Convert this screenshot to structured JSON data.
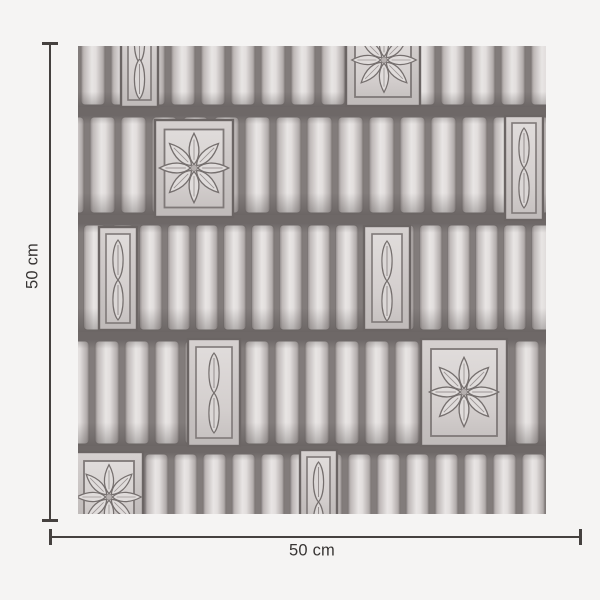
{
  "dimensions": {
    "height_label": "50 cm",
    "width_label": "50 cm"
  },
  "swatch": {
    "kind": "wallpaper-pattern-sample",
    "motifs": [
      "vertical-ribbed-slats",
      "eight-petal-flower-medallion",
      "leaf-chain-panel"
    ]
  },
  "colors": {
    "page_background": "#f5f4f3",
    "dimension_line": "#45413f",
    "label_text": "#383534",
    "pattern_seam": "#6e6867",
    "pattern_gap": "#827c7b",
    "pattern_slat_light": "#e7e4e3",
    "pattern_slat_dark": "#8f8988",
    "panel_frame": "#c9c4c3",
    "panel_fill": "#d9d5d4",
    "motif_outline": "#756f6e"
  }
}
